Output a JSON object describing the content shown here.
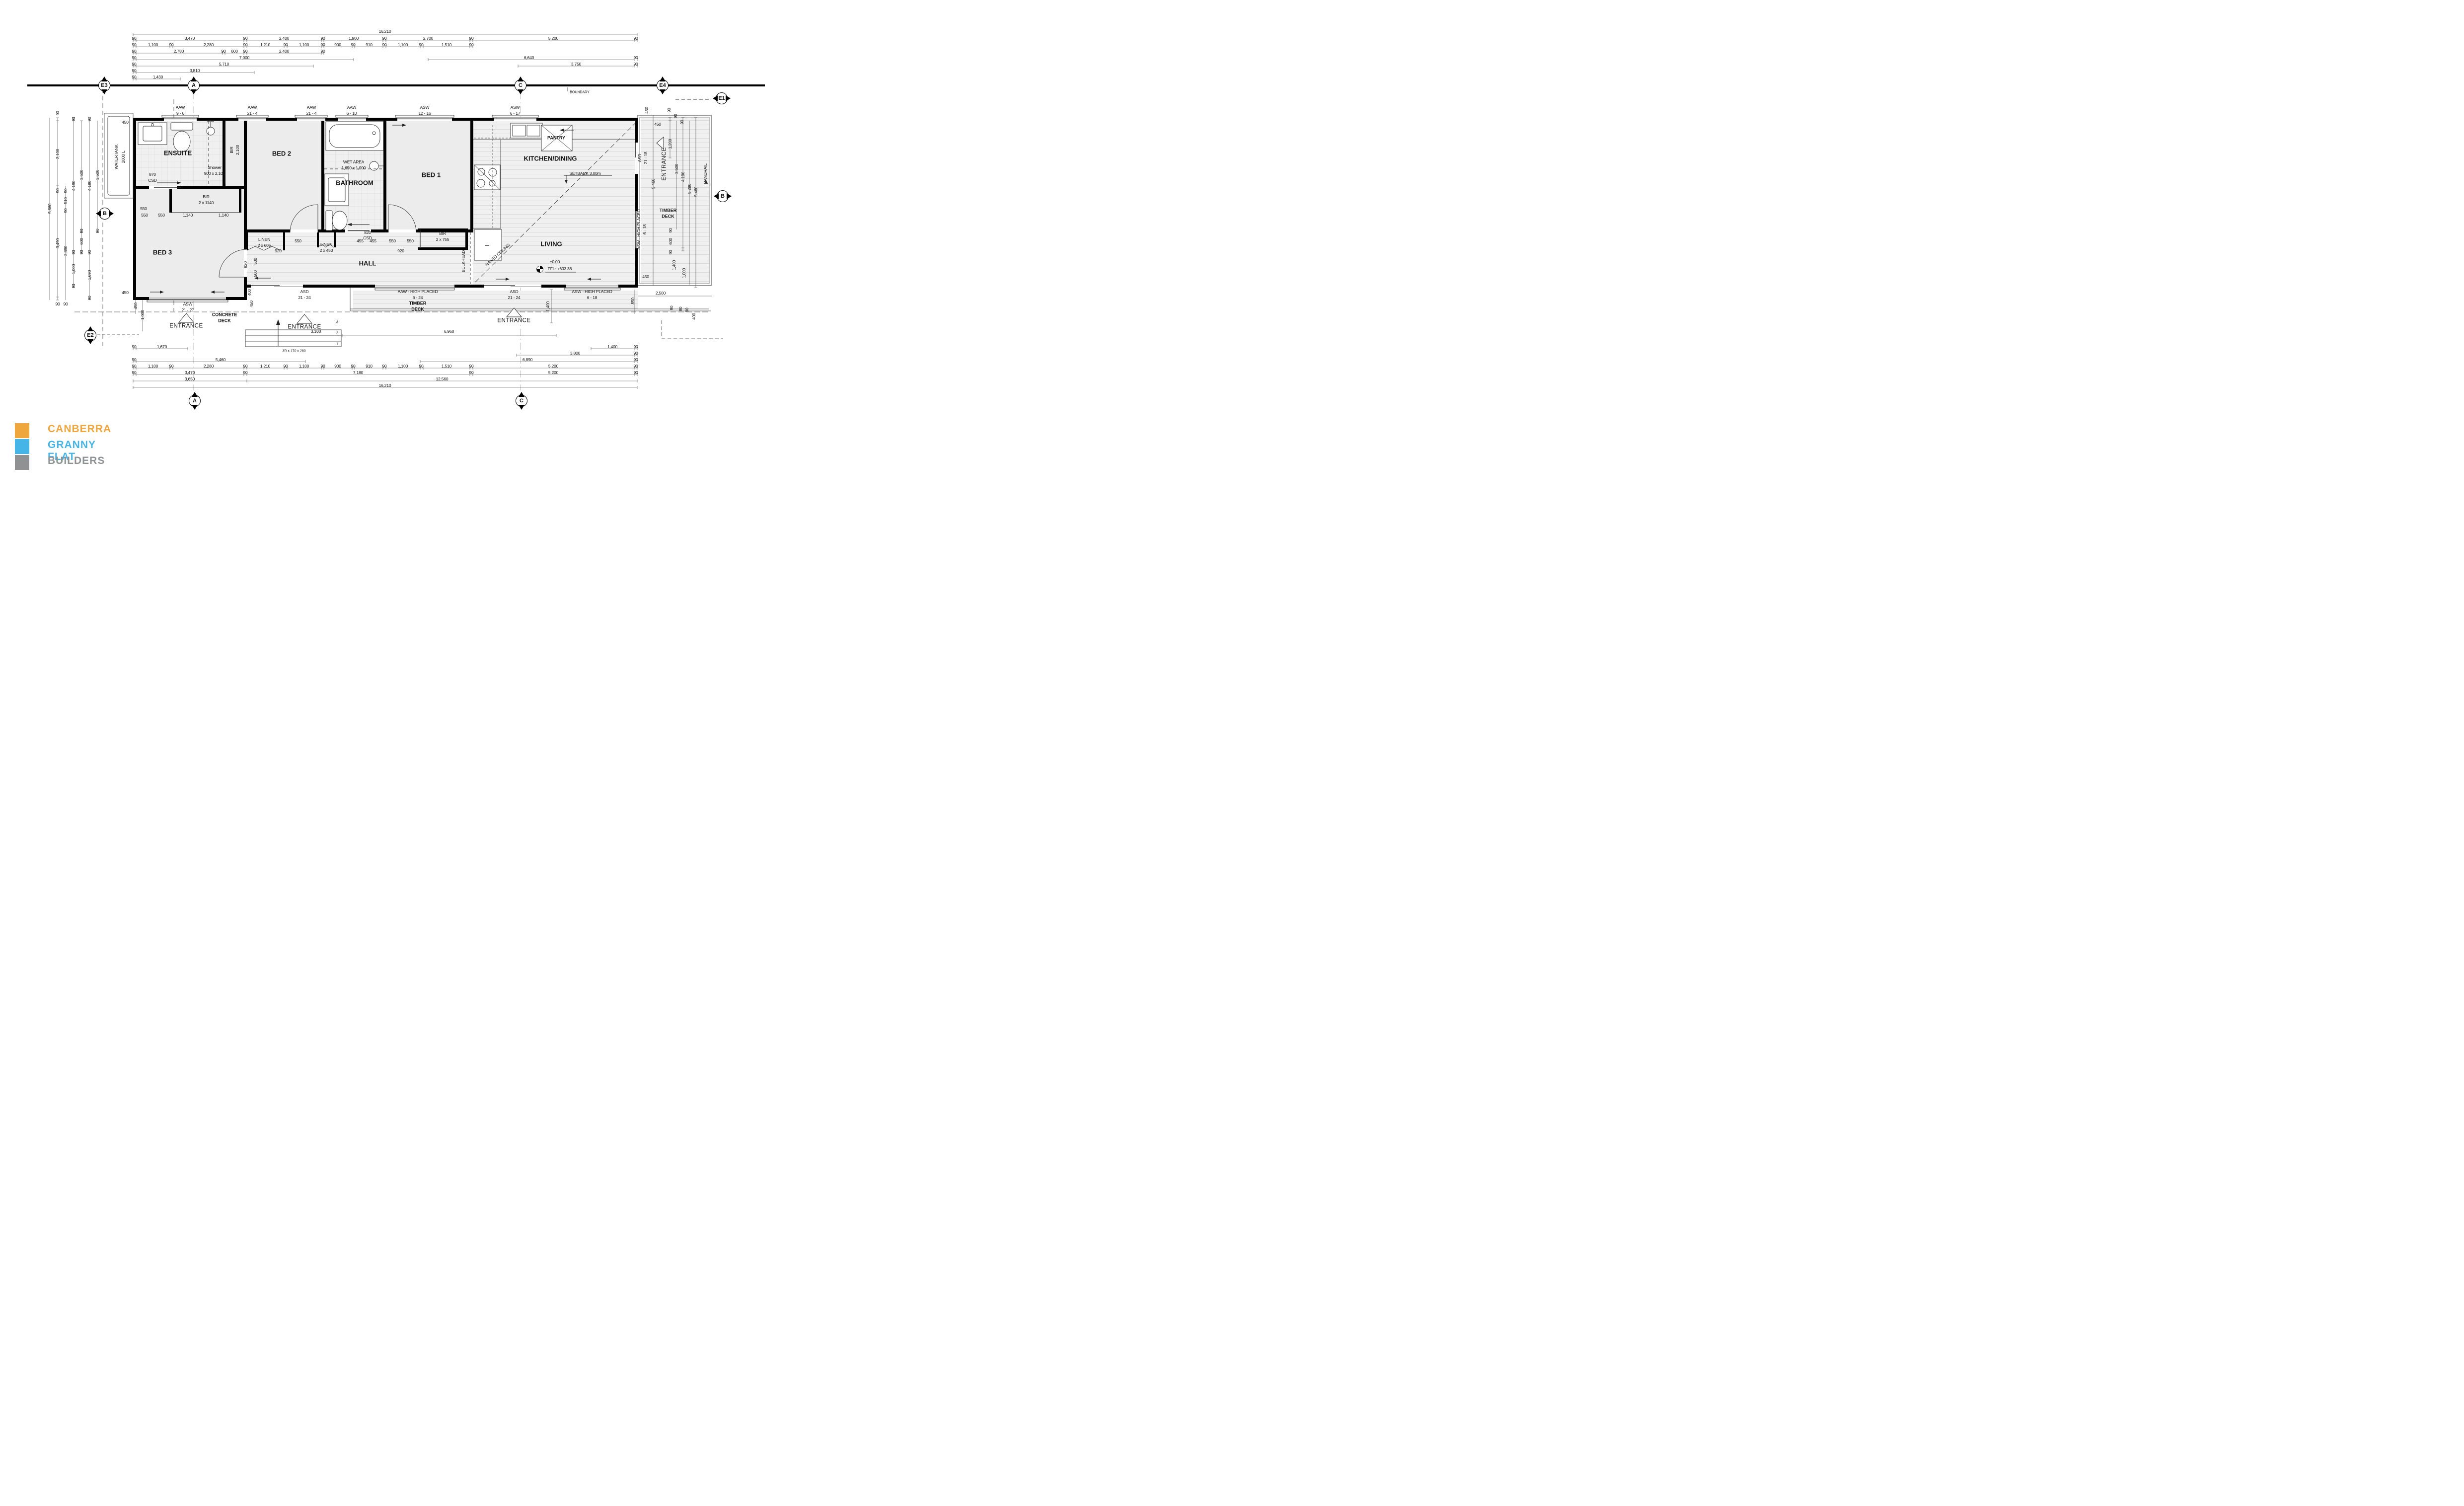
{
  "logo": {
    "line1": "CANBERRA",
    "line2": "GRANNY FLAT",
    "line3": "BUILDERS",
    "color1": "#EFA63C",
    "color2": "#45B5E8",
    "color3": "#8F9193"
  },
  "grid_bubbles": [
    [
      "E3",
      210,
      172,
      "bv"
    ],
    [
      "A",
      390,
      172,
      "bv"
    ],
    [
      "C",
      1048,
      172,
      "bv"
    ],
    [
      "E4",
      1334,
      172,
      "bv"
    ],
    [
      "E1",
      1453,
      198,
      "bh"
    ],
    [
      "B",
      211,
      430,
      "bh"
    ],
    [
      "B",
      1455,
      395,
      "bh"
    ],
    [
      "E2",
      182,
      675,
      "bv"
    ],
    [
      "A",
      392,
      807,
      "bv"
    ],
    [
      "C",
      1050,
      807,
      "bv"
    ]
  ],
  "annotations": [
    [
      "16,210",
      775,
      63,
      "d"
    ],
    [
      "90",
      270,
      77,
      "d"
    ],
    [
      "3,470",
      382,
      77,
      "d"
    ],
    [
      "90",
      494,
      77,
      "d"
    ],
    [
      "2,400",
      572,
      77,
      "d"
    ],
    [
      "90",
      650,
      77,
      "d"
    ],
    [
      "1,900",
      712,
      77,
      "d"
    ],
    [
      "90",
      774,
      77,
      "d"
    ],
    [
      "2,700",
      862,
      77,
      "d"
    ],
    [
      "90",
      949,
      77,
      "d"
    ],
    [
      "5,200",
      1114,
      77,
      "d"
    ],
    [
      "90",
      1280,
      77,
      "d"
    ],
    [
      "90",
      270,
      90,
      "d"
    ],
    [
      "1,100",
      308,
      90,
      "d"
    ],
    [
      "90",
      345,
      90,
      "d"
    ],
    [
      "2,280",
      420,
      90,
      "d"
    ],
    [
      "90",
      494,
      90,
      "d"
    ],
    [
      "1,210",
      534,
      90,
      "d"
    ],
    [
      "90",
      575,
      90,
      "d"
    ],
    [
      "1,100",
      612,
      90,
      "d"
    ],
    [
      "90",
      650,
      90,
      "d"
    ],
    [
      "900",
      680,
      90,
      "d"
    ],
    [
      "90",
      711,
      90,
      "d"
    ],
    [
      "910",
      743,
      90,
      "d"
    ],
    [
      "90",
      774,
      90,
      "d"
    ],
    [
      "1,100",
      811,
      90,
      "d"
    ],
    [
      "90",
      848,
      90,
      "d"
    ],
    [
      "1,510",
      899,
      90,
      "d"
    ],
    [
      "90",
      949,
      90,
      "d"
    ],
    [
      "90",
      270,
      103,
      "d"
    ],
    [
      "2,780",
      360,
      103,
      "d"
    ],
    [
      "90",
      450,
      103,
      "d"
    ],
    [
      "600",
      472,
      103,
      "d"
    ],
    [
      "90",
      494,
      103,
      "d"
    ],
    [
      "2,400",
      572,
      103,
      "d"
    ],
    [
      "90",
      650,
      103,
      "d"
    ],
    [
      "90",
      270,
      116,
      "d"
    ],
    [
      "7,000",
      492,
      116,
      "d"
    ],
    [
      "6,640",
      1065,
      116,
      "d"
    ],
    [
      "90",
      1280,
      116,
      "d"
    ],
    [
      "90",
      270,
      129,
      "d"
    ],
    [
      "5,710",
      451,
      129,
      "d"
    ],
    [
      "3,750",
      1160,
      129,
      "d"
    ],
    [
      "90",
      1280,
      129,
      "d"
    ],
    [
      "90",
      270,
      142,
      "d"
    ],
    [
      "3,810",
      392,
      142,
      "d"
    ],
    [
      "90",
      270,
      155,
      "d"
    ],
    [
      "1,430",
      318,
      155,
      "d"
    ],
    [
      "BOUNDARY",
      1167,
      186,
      "d7"
    ],
    [
      "AAW",
      363,
      216,
      "w"
    ],
    [
      "9 - 6",
      363,
      228,
      "w"
    ],
    [
      "AAW",
      508,
      216,
      "w"
    ],
    [
      "21 - 4",
      508,
      228,
      "w"
    ],
    [
      "AAW",
      627,
      216,
      "w"
    ],
    [
      "21 - 4",
      627,
      228,
      "w"
    ],
    [
      "AAW",
      708,
      216,
      "w"
    ],
    [
      "6 - 10",
      708,
      228,
      "w"
    ],
    [
      "ASW",
      855,
      216,
      "w"
    ],
    [
      "12 - 16",
      855,
      228,
      "w"
    ],
    [
      "ASW",
      1037,
      216,
      "w"
    ],
    [
      "6 - 17",
      1037,
      228,
      "w"
    ],
    [
      "ASD",
      1288,
      318,
      "w",
      -90
    ],
    [
      "21 - 18",
      1300,
      318,
      "w",
      -90
    ],
    [
      "ASW - HIGH PLACED",
      1286,
      462,
      "w",
      -90
    ],
    [
      "6 - 18",
      1298,
      462,
      "w",
      -90
    ],
    [
      "ASD",
      613,
      587,
      "w"
    ],
    [
      "21 - 24",
      613,
      599,
      "w"
    ],
    [
      "AAW - HIGH PLACED",
      841,
      587,
      "w"
    ],
    [
      "6 - 24",
      841,
      599,
      "w"
    ],
    [
      "ASD",
      1035,
      587,
      "w"
    ],
    [
      "21 - 24",
      1035,
      599,
      "w"
    ],
    [
      "ASW - HIGH PLACED",
      1192,
      587,
      "w"
    ],
    [
      "6 - 18",
      1192,
      599,
      "w"
    ],
    [
      "ASW",
      378,
      612,
      "w"
    ],
    [
      "21 - 27",
      378,
      624,
      "w"
    ],
    [
      "ENSUITE",
      358,
      308,
      "r"
    ],
    [
      "BED 2",
      567,
      309,
      "r"
    ],
    [
      "BATHROOM",
      714,
      368,
      "r"
    ],
    [
      "BED 1",
      868,
      352,
      "r"
    ],
    [
      "KITCHEN/DINING",
      1108,
      319,
      "r"
    ],
    [
      "LIVING",
      1110,
      491,
      "r"
    ],
    [
      "BED 3",
      327,
      508,
      "r"
    ],
    [
      "HALL",
      740,
      530,
      "r"
    ],
    [
      "PANTRY",
      1120,
      278,
      "r2"
    ],
    [
      "WET AREA",
      712,
      326,
      "d"
    ],
    [
      "1,650 x 1,900",
      712,
      338,
      "d"
    ],
    [
      "Shower",
      432,
      337,
      "d"
    ],
    [
      "900 x 2,100",
      432,
      349,
      "d"
    ],
    [
      "870",
      307,
      351,
      "d"
    ],
    [
      "CSD",
      307,
      363,
      "d"
    ],
    [
      "820",
      740,
      468,
      "d"
    ],
    [
      "CSD",
      740,
      479,
      "d"
    ],
    [
      "BIR",
      466,
      302,
      "d",
      -90
    ],
    [
      "2,100",
      478,
      302,
      "d",
      -90
    ],
    [
      "BIR",
      415,
      396,
      "d"
    ],
    [
      "2 x 1140",
      415,
      408,
      "d"
    ],
    [
      "LINEN",
      532,
      482,
      "d"
    ],
    [
      "2 x 605",
      532,
      494,
      "d"
    ],
    [
      "LINEN",
      657,
      492,
      "d"
    ],
    [
      "2 x 450",
      657,
      504,
      "d"
    ],
    [
      "BIR",
      891,
      470,
      "d"
    ],
    [
      "2 x 755",
      891,
      482,
      "d"
    ],
    [
      "550",
      291,
      433,
      "d"
    ],
    [
      "550",
      325,
      433,
      "d"
    ],
    [
      "1,140",
      378,
      433,
      "d"
    ],
    [
      "1,140",
      450,
      433,
      "d"
    ],
    [
      "550",
      600,
      485,
      "d"
    ],
    [
      "455",
      725,
      485,
      "d"
    ],
    [
      "455",
      751,
      485,
      "d"
    ],
    [
      "550",
      790,
      485,
      "d"
    ],
    [
      "550",
      826,
      485,
      "d"
    ],
    [
      "920",
      560,
      505,
      "d"
    ],
    [
      "920",
      807,
      505,
      "d"
    ],
    [
      "920",
      494,
      533,
      "d",
      -90
    ],
    [
      "500",
      514,
      526,
      "d",
      -90
    ],
    [
      "500",
      514,
      551,
      "d",
      -90
    ],
    [
      "400",
      502,
      589,
      "d",
      -90
    ],
    [
      "450",
      506,
      612,
      "d",
      -90
    ],
    [
      "450",
      273,
      616,
      "d",
      -90
    ],
    [
      "1,000",
      287,
      634,
      "d",
      -90
    ],
    [
      "F",
      982,
      492,
      "e",
      -90
    ],
    [
      "SETBACK 3.00m",
      1178,
      349,
      "d"
    ],
    [
      "RAKED CEILING",
      1002,
      513,
      "d",
      -42
    ],
    [
      "BULKHEAD",
      933,
      526,
      "d",
      -90
    ],
    [
      "±0.00",
      1117,
      527,
      "d"
    ],
    [
      "FFL: +603.36",
      1127,
      541,
      "d"
    ],
    [
      "WATERTANK",
      234,
      316,
      "d",
      -90
    ],
    [
      "2000 L",
      248,
      316,
      "d",
      -90
    ],
    [
      "450",
      252,
      246,
      "d"
    ],
    [
      "450",
      252,
      589,
      "d"
    ],
    [
      "550",
      289,
      420,
      "d"
    ],
    [
      "TIMBER",
      1345,
      424,
      "r2"
    ],
    [
      "DECK",
      1345,
      436,
      "r2"
    ],
    [
      "HANDRAIL",
      1420,
      350,
      "d",
      -90
    ],
    [
      "TIMBER",
      841,
      611,
      "r2"
    ],
    [
      "DECK",
      841,
      623,
      "r2"
    ],
    [
      "CONCRETE",
      452,
      634,
      "r2"
    ],
    [
      "DECK",
      452,
      646,
      "r2"
    ],
    [
      "ENTRANCE",
      375,
      657,
      "e"
    ],
    [
      "ENTRANCE",
      613,
      659,
      "e"
    ],
    [
      "ENTRANCE",
      1035,
      646,
      "e"
    ],
    [
      "ENTRANCE",
      1338,
      330,
      "e",
      -90
    ],
    [
      "3,100",
      636,
      667,
      "d"
    ],
    [
      "6,960",
      904,
      667,
      "d"
    ],
    [
      "3",
      679,
      649,
      "d7"
    ],
    [
      "2",
      679,
      671,
      "d7"
    ],
    [
      "1",
      679,
      693,
      "d7"
    ],
    [
      "3R x 170 x 280",
      592,
      707,
      "d7"
    ],
    [
      "1,400",
      1103,
      617,
      "d",
      -90
    ],
    [
      "850",
      1274,
      606,
      "d",
      -90
    ],
    [
      "450",
      1300,
      557,
      "d"
    ],
    [
      "2,500",
      1330,
      590,
      "d"
    ],
    [
      "450",
      1302,
      222,
      "d",
      -90
    ],
    [
      "450",
      1324,
      250,
      "d"
    ],
    [
      "90",
      1347,
      222,
      "d",
      -90
    ],
    [
      "90",
      1360,
      234,
      "d",
      -90
    ],
    [
      "90",
      1373,
      246,
      "d",
      -90
    ],
    [
      "1,200",
      1349,
      290,
      "d",
      -90
    ],
    [
      "3,500",
      1362,
      340,
      "d",
      -90
    ],
    [
      "4,190",
      1375,
      356,
      "d",
      -90
    ],
    [
      "5,280",
      1388,
      380,
      "d",
      -90
    ],
    [
      "5,460",
      1401,
      386,
      "d",
      -90
    ],
    [
      "5,460",
      1315,
      370,
      "d",
      -90
    ],
    [
      "90",
      1350,
      464,
      "d",
      -90
    ],
    [
      "600",
      1350,
      486,
      "d",
      -90
    ],
    [
      "90",
      1350,
      508,
      "d",
      -90
    ],
    [
      "1,400",
      1357,
      534,
      "d",
      -90
    ],
    [
      "1,000",
      1377,
      550,
      "d",
      -90
    ],
    [
      "90",
      1352,
      620,
      "d",
      -90
    ],
    [
      "90",
      1370,
      622,
      "d",
      -90
    ],
    [
      "90",
      1383,
      624,
      "d",
      -90
    ],
    [
      "400",
      1397,
      637,
      "d",
      -90
    ],
    [
      "5,860",
      100,
      420,
      "d",
      -90
    ],
    [
      "90",
      116,
      228,
      "d",
      -90
    ],
    [
      "2,100",
      116,
      310,
      "d",
      -90
    ],
    [
      "90",
      116,
      384,
      "d",
      -90
    ],
    [
      "3,490",
      116,
      490,
      "d",
      -90
    ],
    [
      "90",
      132,
      384,
      "d",
      -90
    ],
    [
      "510",
      132,
      404,
      "d",
      -90
    ],
    [
      "90",
      132,
      424,
      "d",
      -90
    ],
    [
      "2,890",
      132,
      505,
      "d",
      -90
    ],
    [
      "90",
      148,
      240,
      "d",
      -90
    ],
    [
      "4,190",
      148,
      374,
      "d",
      -90
    ],
    [
      "90",
      148,
      508,
      "d",
      -90
    ],
    [
      "1,000",
      148,
      542,
      "d",
      -90
    ],
    [
      "90",
      148,
      576,
      "d",
      -90
    ],
    [
      "3,500",
      164,
      352,
      "d",
      -90
    ],
    [
      "90",
      164,
      465,
      "d",
      -90
    ],
    [
      "600",
      164,
      486,
      "d",
      -90
    ],
    [
      "90",
      164,
      508,
      "d",
      -90
    ],
    [
      "90",
      180,
      240,
      "d",
      -90
    ],
    [
      "4,190",
      180,
      374,
      "d",
      -90
    ],
    [
      "90",
      180,
      508,
      "d",
      -90
    ],
    [
      "1,690",
      180,
      554,
      "d",
      -90
    ],
    [
      "90",
      180,
      600,
      "d",
      -90
    ],
    [
      "3,500",
      196,
      352,
      "d",
      -90
    ],
    [
      "90",
      196,
      465,
      "d",
      -90
    ],
    [
      "90",
      116,
      612,
      "d"
    ],
    [
      "90",
      132,
      612,
      "d"
    ],
    [
      "90",
      270,
      698,
      "d"
    ],
    [
      "1,670",
      326,
      698,
      "d"
    ],
    [
      "1,400",
      1233,
      698,
      "d"
    ],
    [
      "90",
      1280,
      698,
      "d"
    ],
    [
      "3,800",
      1158,
      711,
      "d"
    ],
    [
      "90",
      1280,
      711,
      "d"
    ],
    [
      "90",
      270,
      724,
      "d"
    ],
    [
      "5,460",
      444,
      724,
      "d"
    ],
    [
      "6,890",
      1062,
      724,
      "d"
    ],
    [
      "90",
      1280,
      724,
      "d"
    ],
    [
      "90",
      270,
      737,
      "d"
    ],
    [
      "1,100",
      308,
      737,
      "d"
    ],
    [
      "90",
      345,
      737,
      "d"
    ],
    [
      "2,280",
      420,
      737,
      "d"
    ],
    [
      "90",
      494,
      737,
      "d"
    ],
    [
      "1,210",
      534,
      737,
      "d"
    ],
    [
      "90",
      575,
      737,
      "d"
    ],
    [
      "1,100",
      612,
      737,
      "d"
    ],
    [
      "90",
      650,
      737,
      "d"
    ],
    [
      "900",
      680,
      737,
      "d"
    ],
    [
      "90",
      711,
      737,
      "d"
    ],
    [
      "910",
      743,
      737,
      "d"
    ],
    [
      "90",
      774,
      737,
      "d"
    ],
    [
      "1,100",
      811,
      737,
      "d"
    ],
    [
      "90",
      848,
      737,
      "d"
    ],
    [
      "1,510",
      899,
      737,
      "d"
    ],
    [
      "90",
      949,
      737,
      "d"
    ],
    [
      "5,200",
      1114,
      737,
      "d"
    ],
    [
      "90",
      1280,
      737,
      "d"
    ],
    [
      "90",
      270,
      750,
      "d"
    ],
    [
      "3,470",
      382,
      750,
      "d"
    ],
    [
      "90",
      494,
      750,
      "d"
    ],
    [
      "7,180",
      721,
      750,
      "d"
    ],
    [
      "90",
      949,
      750,
      "d"
    ],
    [
      "5,200",
      1114,
      750,
      "d"
    ],
    [
      "90",
      1280,
      750,
      "d"
    ],
    [
      "3,650",
      382,
      763,
      "d"
    ],
    [
      "12,560",
      890,
      763,
      "d"
    ],
    [
      "16,210",
      775,
      776,
      "d"
    ]
  ]
}
